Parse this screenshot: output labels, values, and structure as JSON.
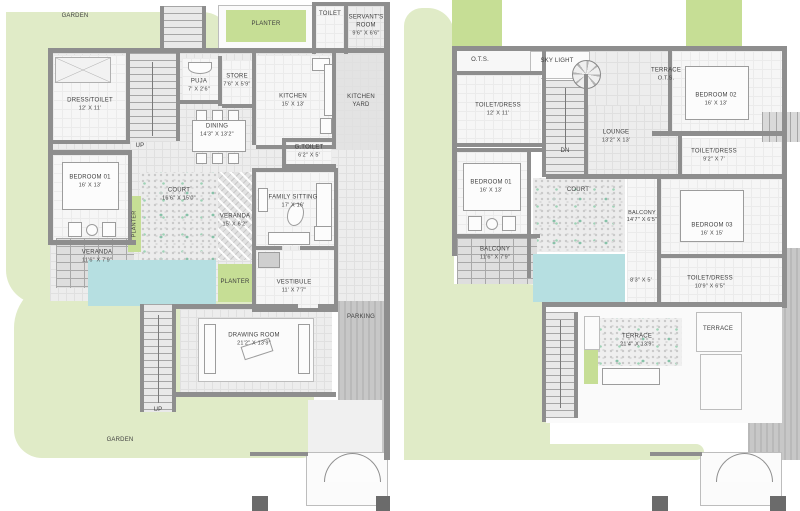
{
  "document": {
    "type": "residential floor plan drawing",
    "panels": [
      "ground floor",
      "first floor"
    ]
  },
  "colors": {
    "garden": "#e0ebc7",
    "planter": "#c6de95",
    "pool": "#b6dfe1",
    "wall": "#8e8e8e",
    "label_text": "#3f3f3f"
  },
  "gf": {
    "garden_top": {
      "name": "GARDEN"
    },
    "garden_bottom": {
      "name": "GARDEN"
    },
    "planter_top": {
      "name": "PLANTER"
    },
    "toilet": {
      "name": "TOILET"
    },
    "servant": {
      "name": "SERVANT'S ROOM",
      "dim": "9'6\" X 6'6\""
    },
    "dress_toilet": {
      "name": "DRESS/TOILET",
      "dim": "12' X 11'"
    },
    "up_top": {
      "name": "UP"
    },
    "up_bottom": {
      "name": "UP"
    },
    "puja": {
      "name": "PUJA",
      "dim": "7' X 2'6\""
    },
    "store": {
      "name": "STORE",
      "dim": "7'6\" X 5'9\""
    },
    "kitchen": {
      "name": "KITCHEN",
      "dim": "15' X 13'"
    },
    "kitchen_yard": {
      "name": "KITCHEN YARD"
    },
    "dining": {
      "name": "DINING",
      "dim": "14'3\" X 13'2\""
    },
    "g_toilet": {
      "name": "G.TOILET",
      "dim": "6'2\" X 5'"
    },
    "bedroom01": {
      "name": "BEDROOM 01",
      "dim": "16' X 13'"
    },
    "court": {
      "name": "COURT",
      "dim": "16'6\" X 15'0\""
    },
    "planter_court": {
      "name": "PLANTER"
    },
    "veranda_right": {
      "name": "VERANDA",
      "dim": "15' X 6'2\""
    },
    "family_sitting": {
      "name": "FAMILY SITTING",
      "dim": "17' X 16'"
    },
    "veranda_left": {
      "name": "VERANDA",
      "dim": "11'6\" X 7'9\""
    },
    "planter_mid": {
      "name": "PLANTER"
    },
    "vestibule": {
      "name": "VESTIBULE",
      "dim": "11' X 7'7\""
    },
    "parking": {
      "name": "PARKING"
    },
    "drawing_room": {
      "name": "DRAWING ROOM",
      "dim": "21'2\" X 13'9\""
    }
  },
  "ff": {
    "ots": {
      "name": "O.T.S."
    },
    "sky_light": {
      "name": "SKY LIGHT"
    },
    "terrace_top": {
      "name": "TERRACE",
      "dim": "O.T.S."
    },
    "bedroom02": {
      "name": "BEDROOM 02",
      "dim": "16' X 13'"
    },
    "toilet_dress_1": {
      "name": "TOILET/DRESS",
      "dim": "12' X 11'"
    },
    "lounge": {
      "name": "LOUNGE",
      "dim": "13'2\" X 13'"
    },
    "dn": {
      "name": "DN"
    },
    "toilet_dress_2": {
      "name": "TOILET/DRESS",
      "dim": "9'2\" X 7'"
    },
    "bedroom01": {
      "name": "BEDROOM 01",
      "dim": "16' X 13'"
    },
    "court": {
      "name": "COURT"
    },
    "balcony_east": {
      "name": "BALCONY",
      "dim": "14'7\" X 6'5\""
    },
    "bedroom03": {
      "name": "BEDROOM 03",
      "dim": "16' X 15'"
    },
    "balcony_west": {
      "name": "BALCONY",
      "dim": "11'6\" X 7'9\""
    },
    "passage": {
      "dim": "8'3\" X 5'"
    },
    "toilet_dress_3": {
      "name": "TOILET/DRESS",
      "dim": "10'9\" X 6'5\""
    },
    "terrace_main": {
      "name": "TERRACE",
      "dim": "21'4\" X 13'9\""
    },
    "terrace_small": {
      "name": "TERRACE"
    }
  }
}
